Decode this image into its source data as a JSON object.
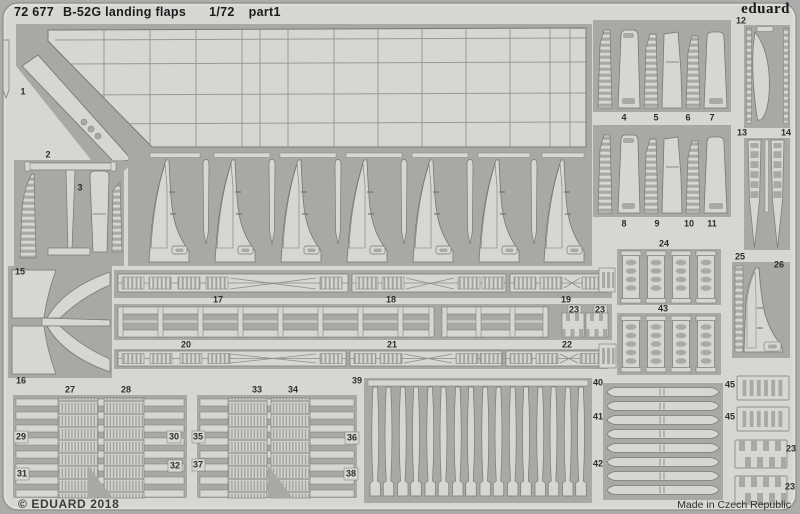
{
  "header": {
    "catalog_number": "72 677",
    "title": "B-52G landing flaps",
    "scale": "1/72",
    "sheet_part": "part1"
  },
  "brand": {
    "logo_text": "eduard"
  },
  "footer": {
    "copyright": "© EDUARD 2018",
    "origin": "Made in Czech Republic"
  },
  "colors": {
    "background": "#acacaa",
    "sheet_metal": "#d6d6d3",
    "etched_recess": "#a8a8a5",
    "etch_line": "#787874",
    "ink": "#1c1c1c"
  },
  "part_labels": [
    "1",
    "2",
    "3",
    "4",
    "5",
    "6",
    "7",
    "8",
    "9",
    "10",
    "11",
    "12",
    "13",
    "14",
    "15",
    "16",
    "17",
    "18",
    "19",
    "20",
    "21",
    "22",
    "23",
    "23",
    "24",
    "43",
    "25",
    "26",
    "27",
    "28",
    "29",
    "30",
    "31",
    "32",
    "33",
    "34",
    "35",
    "36",
    "37",
    "38",
    "39",
    "40",
    "41",
    "42",
    "45",
    "45",
    "23",
    "23"
  ]
}
